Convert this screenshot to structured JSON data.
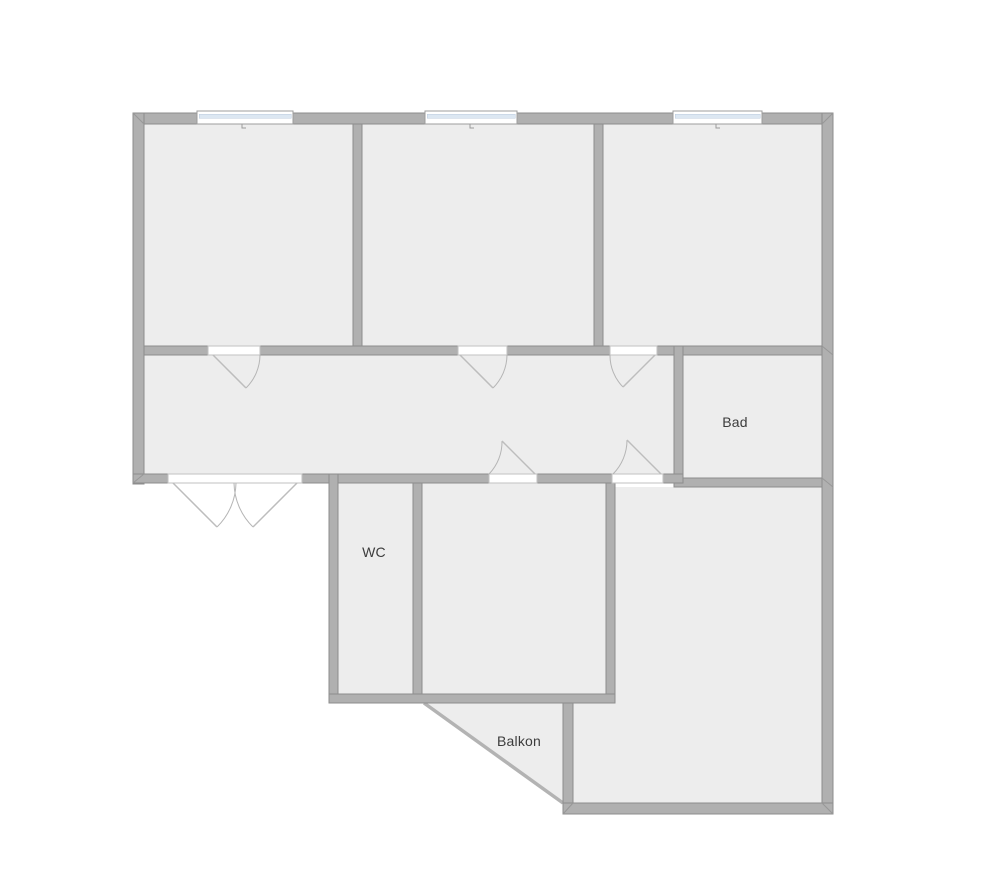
{
  "floorplan": {
    "labels": {
      "bad": "Bad",
      "wc": "WC",
      "balkon": "Balkon"
    },
    "rooms": [
      {
        "id": "room-top-left",
        "label": ""
      },
      {
        "id": "room-top-middle",
        "label": ""
      },
      {
        "id": "room-top-right",
        "label": ""
      },
      {
        "id": "corridor",
        "label": ""
      },
      {
        "id": "bad",
        "label": "Bad"
      },
      {
        "id": "wc",
        "label": "WC"
      },
      {
        "id": "room-bottom-middle",
        "label": ""
      },
      {
        "id": "room-bottom-right",
        "label": ""
      },
      {
        "id": "balkon",
        "label": "Balkon"
      }
    ],
    "colors": {
      "background": "#ffffff",
      "wall": "#b0b0b0",
      "wall_outline": "#8d8d8d",
      "room_fill": "#ededed",
      "window_glass": "#dce7f2",
      "door_swing": "#b5b5b5",
      "text": "#3c3c3c"
    }
  }
}
